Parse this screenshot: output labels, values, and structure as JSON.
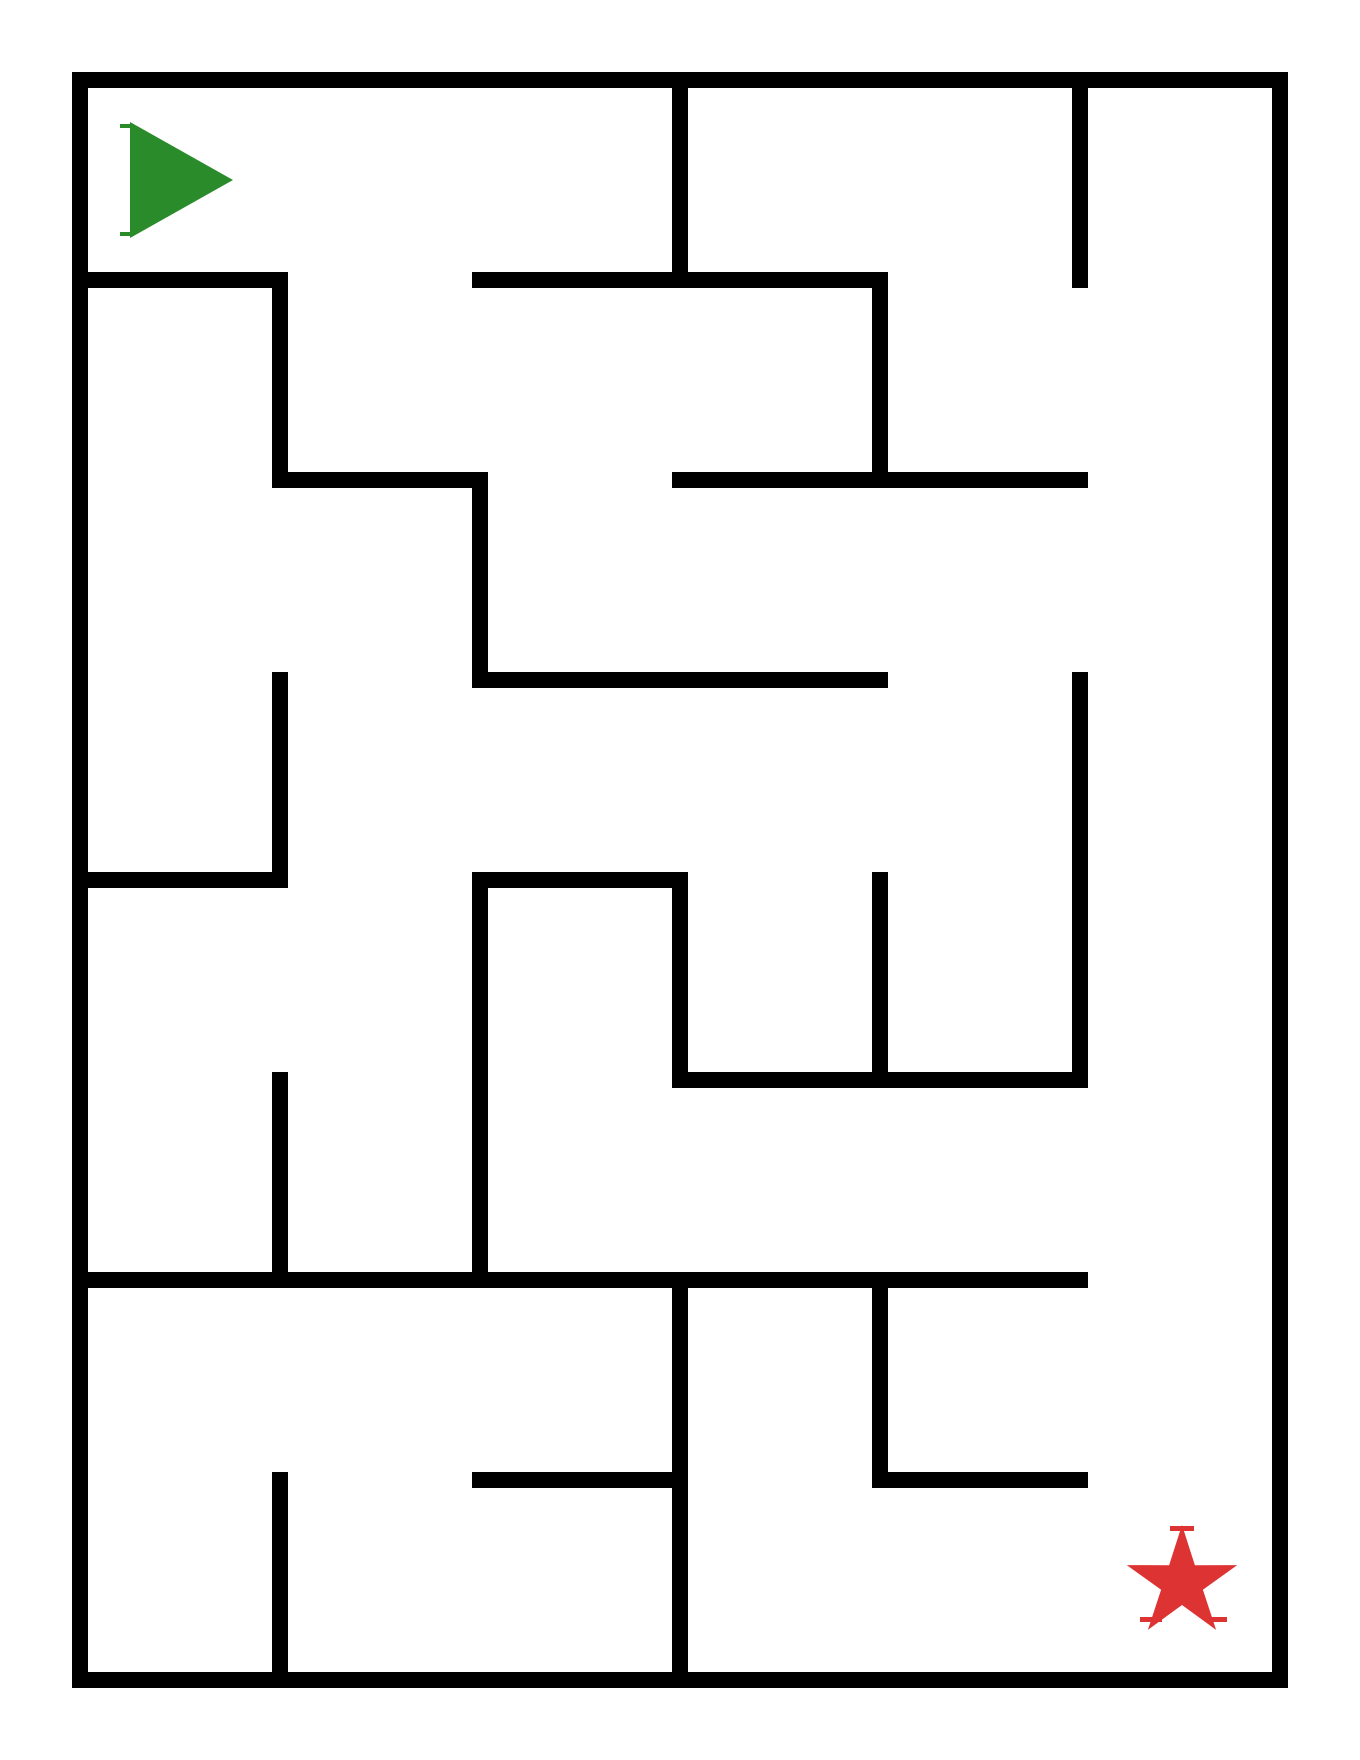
{
  "canvas": {
    "width": 1360,
    "height": 1760,
    "background_color": "#ffffff"
  },
  "maze": {
    "origin_x": 80,
    "origin_y": 80,
    "cell_size": 200,
    "cols": 6,
    "rows": 8,
    "wall_thickness": 16,
    "wall_color": "#000000",
    "vertical_walls": [
      {
        "col": 1,
        "from_row": 1,
        "to_row": 2
      },
      {
        "col": 1,
        "from_row": 3,
        "to_row": 4
      },
      {
        "col": 1,
        "from_row": 5,
        "to_row": 6
      },
      {
        "col": 1,
        "from_row": 7,
        "to_row": 8
      },
      {
        "col": 2,
        "from_row": 2,
        "to_row": 3
      },
      {
        "col": 2,
        "from_row": 4,
        "to_row": 6
      },
      {
        "col": 3,
        "from_row": 0,
        "to_row": 1
      },
      {
        "col": 3,
        "from_row": 4,
        "to_row": 5
      },
      {
        "col": 3,
        "from_row": 6,
        "to_row": 8
      },
      {
        "col": 4,
        "from_row": 1,
        "to_row": 2
      },
      {
        "col": 4,
        "from_row": 4,
        "to_row": 5
      },
      {
        "col": 4,
        "from_row": 6,
        "to_row": 7
      },
      {
        "col": 5,
        "from_row": 0,
        "to_row": 1
      },
      {
        "col": 5,
        "from_row": 3,
        "to_row": 5
      }
    ],
    "horizontal_walls": [
      {
        "row": 1,
        "from_col": 0,
        "to_col": 1
      },
      {
        "row": 1,
        "from_col": 2,
        "to_col": 4
      },
      {
        "row": 2,
        "from_col": 1,
        "to_col": 2
      },
      {
        "row": 2,
        "from_col": 3,
        "to_col": 5
      },
      {
        "row": 3,
        "from_col": 2,
        "to_col": 4
      },
      {
        "row": 4,
        "from_col": 0,
        "to_col": 1
      },
      {
        "row": 4,
        "from_col": 2,
        "to_col": 3
      },
      {
        "row": 5,
        "from_col": 3,
        "to_col": 5
      },
      {
        "row": 6,
        "from_col": 0,
        "to_col": 5
      },
      {
        "row": 7,
        "from_col": 2,
        "to_col": 3
      },
      {
        "row": 7,
        "from_col": 4,
        "to_col": 5
      }
    ]
  },
  "start_marker": {
    "shape": "right-pointing-triangle",
    "color": "#2a8b2a",
    "cell_col": 0,
    "cell_row": 0,
    "points": [
      [
        130,
        122
      ],
      [
        233,
        180
      ],
      [
        130,
        238
      ]
    ],
    "ticks": [
      {
        "x": 120,
        "y": 124,
        "w": 14,
        "h": 4
      },
      {
        "x": 120,
        "y": 232,
        "w": 14,
        "h": 4
      }
    ]
  },
  "goal_marker": {
    "shape": "five-point-star",
    "color": "#dd3333",
    "cell_col": 5,
    "cell_row": 7,
    "center_x": 1182,
    "center_y": 1583,
    "outer_radius": 58,
    "inner_radius": 22,
    "ticks": [
      {
        "x": 1170,
        "y": 1526,
        "w": 24,
        "h": 5
      },
      {
        "x": 1140,
        "y": 1617,
        "w": 22,
        "h": 5
      },
      {
        "x": 1205,
        "y": 1617,
        "w": 22,
        "h": 5
      }
    ]
  }
}
